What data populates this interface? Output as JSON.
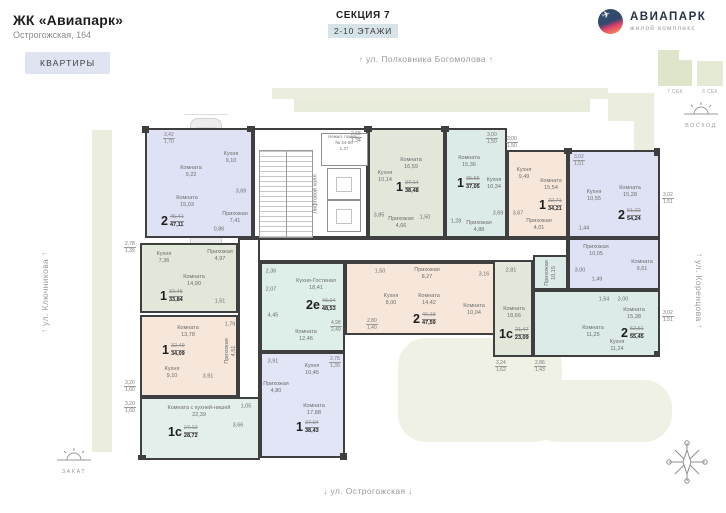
{
  "header": {
    "title": "ЖК «Авиапарк»",
    "address": "Острогожская, 164",
    "apartments_button": "КВАРТИРЫ",
    "section": "СЕКЦИЯ 7",
    "floors": "2-10 ЭТАЖИ",
    "logo": {
      "name": "АВИАПАРК",
      "subtitle": "жилой комплекс"
    }
  },
  "icons": {
    "arrow_up": "↑",
    "arrow_down": "↓",
    "plane": "✈"
  },
  "minimap": {
    "sec7": "7 СЕК",
    "sec6": "6 СЕК"
  },
  "streets": {
    "top": "ул. Полковника Богомолова",
    "left": "ул. Ключникова",
    "right": "ул. Коренцова",
    "bottom": "ул. Острогожская"
  },
  "markers": {
    "sunrise": "ВОСХОД",
    "sunset": "ЗАКАТ"
  },
  "core": {
    "nonres_l1": "Нежил. помещ.",
    "nonres_l2": "№ 44-50",
    "nonres_area": "1,47",
    "hall": "Лифтовой холл"
  },
  "apartments": [
    {
      "id": "1",
      "type": "2",
      "area_base": "45,41",
      "area_total": "47,11",
      "rooms": [
        {
          "name": "Комната",
          "area": "9,22"
        },
        {
          "name": "Кухня",
          "area": "9,10"
        },
        {
          "name": "Комната",
          "area": "15,03"
        },
        {
          "name": "Прихожая",
          "area": "7,41"
        },
        {
          "name": "",
          "area": "3,69"
        },
        {
          "name": "",
          "area": "0,86"
        }
      ],
      "balconies": [
        {
          "full": "3,42",
          "half": "1,70"
        }
      ]
    },
    {
      "id": "2",
      "type": "1",
      "area_base": "32,45",
      "area_total": "33,84",
      "rooms": [
        {
          "name": "Кухня",
          "area": "7,36"
        },
        {
          "name": "Прихожая",
          "area": "4,97"
        },
        {
          "name": "Комната",
          "area": "14,90"
        },
        {
          "name": "",
          "area": "1,51"
        }
      ],
      "balconies": [
        {
          "full": "2,78",
          "half": "1,39"
        }
      ]
    },
    {
      "id": "3",
      "type": "1",
      "area_base": "32,49",
      "area_total": "34,09",
      "rooms": [
        {
          "name": "Комната",
          "area": "13,78"
        },
        {
          "name": "",
          "area": "1,79"
        },
        {
          "name": "Прихожая",
          "area": "4,51"
        },
        {
          "name": "Кухня",
          "area": "9,10"
        },
        {
          "name": "",
          "area": "3,91"
        }
      ],
      "balconies": [
        {
          "full": "3,20",
          "half": "1,60"
        }
      ]
    },
    {
      "id": "4",
      "type": "1с",
      "area_base": "27,12",
      "area_total": "28,72",
      "rooms": [
        {
          "name": "Комната с кухней-нишей",
          "area": "22,39"
        },
        {
          "name": "",
          "area": "1,05"
        },
        {
          "name": "",
          "area": "3,66"
        }
      ],
      "balconies": [
        {
          "full": "3,20",
          "half": "1,60"
        }
      ]
    },
    {
      "id": "5",
      "type": "1",
      "area_base": "37,04",
      "area_total": "38,43",
      "rooms": [
        {
          "name": "Кухня",
          "area": "10,45"
        },
        {
          "name": "Прихожая",
          "area": "4,80"
        },
        {
          "name": "Комната",
          "area": "17,88"
        },
        {
          "name": "",
          "area": "3,91"
        }
      ],
      "balconies": [
        {
          "full": "2,78",
          "half": "1,39"
        }
      ]
    },
    {
      "id": "6",
      "type": "2е",
      "area_base": "46,04",
      "area_total": "48,53",
      "rooms": [
        {
          "name": "Кухня-Гостиная",
          "area": "18,41"
        },
        {
          "name": "Комната",
          "area": "12,46"
        },
        {
          "name": "",
          "area": "2,36"
        },
        {
          "name": "",
          "area": "2,07"
        },
        {
          "name": "",
          "area": "4,45"
        }
      ],
      "balconies": [
        {
          "full": "4,98",
          "half": "2,49"
        }
      ]
    },
    {
      "id": "7",
      "type": "2",
      "area_base": "46,19",
      "area_total": "47,59",
      "rooms": [
        {
          "name": "Прихожая",
          "area": "8,27"
        },
        {
          "name": "Кухня",
          "area": "8,00"
        },
        {
          "name": "Комната",
          "area": "14,42"
        },
        {
          "name": "Комната",
          "area": "10,04"
        },
        {
          "name": "",
          "area": "3,16"
        },
        {
          "name": "",
          "area": "1,50"
        }
      ],
      "balconies": [
        {
          "full": "2,80",
          "half": "1,40"
        }
      ]
    },
    {
      "id": "8",
      "type": "1",
      "area_base": "37,14",
      "area_total": "38,48",
      "rooms": [
        {
          "name": "Кухня",
          "area": "10,14"
        },
        {
          "name": "Комната",
          "area": "16,59"
        },
        {
          "name": "Прихожая",
          "area": "4,66"
        },
        {
          "name": "",
          "area": "3,85"
        },
        {
          "name": "",
          "area": "1,50"
        }
      ],
      "balconies": [
        {
          "full": "2,68",
          "half": "1,34"
        }
      ]
    },
    {
      "id": "9",
      "type": "1",
      "area_base": "35,55",
      "area_total": "37,05",
      "rooms": [
        {
          "name": "Комната",
          "area": "15,36"
        },
        {
          "name": "Кухня",
          "area": "10,34"
        },
        {
          "name": "Прихожая",
          "area": "4,88"
        },
        {
          "name": "",
          "area": "3,69"
        },
        {
          "name": "",
          "area": "1,28"
        }
      ],
      "balconies": [
        {
          "full": "3,00",
          "half": "1,50"
        }
      ]
    },
    {
      "id": "10",
      "type": "1",
      "area_base": "32,71",
      "area_total": "34,21",
      "rooms": [
        {
          "name": "Кухня",
          "area": "9,49"
        },
        {
          "name": "Комната",
          "area": "15,54"
        },
        {
          "name": "Прихожая",
          "area": "4,01"
        },
        {
          "name": "",
          "area": "3,67"
        }
      ],
      "balconies": [
        {
          "full": "3,00",
          "half": "1,50"
        }
      ]
    },
    {
      "id": "11",
      "type": "2",
      "area_base": "51,22",
      "area_total": "54,24",
      "rooms": [
        {
          "name": "Кухня",
          "area": "10,55"
        },
        {
          "name": "Комната",
          "area": "15,28"
        },
        {
          "name": "Прихожая",
          "area": "10,05"
        },
        {
          "name": "Комната",
          "area": "9,61"
        },
        {
          "name": "",
          "area": "1,44"
        },
        {
          "name": "",
          "area": "3,00"
        },
        {
          "name": "",
          "area": "1,49"
        }
      ],
      "balconies": [
        {
          "full": "3,02",
          "half": "1,51"
        },
        {
          "full": "3,02",
          "half": "1,51"
        }
      ]
    },
    {
      "id": "12",
      "type": "2",
      "area_base": "52,51",
      "area_total": "55,45",
      "rooms": [
        {
          "name": "Комната",
          "area": "15,38"
        },
        {
          "name": "Комната",
          "area": "11,25"
        },
        {
          "name": "Кухня",
          "area": "11,24"
        },
        {
          "name": "Прихожая",
          "area": "10,15"
        },
        {
          "name": "",
          "area": "1,54"
        },
        {
          "name": "",
          "area": "3,00"
        }
      ],
      "balconies": [
        {
          "full": "2,86",
          "half": "1,43"
        },
        {
          "full": "3,02",
          "half": "1,51"
        }
      ]
    },
    {
      "id": "13",
      "type": "1с",
      "area_base": "21,47",
      "area_total": "23,09",
      "rooms": [
        {
          "name": "Комната",
          "area": "18,66"
        },
        {
          "name": "",
          "area": "2,81"
        }
      ],
      "balconies": [
        {
          "full": "3,24",
          "half": "1,62"
        }
      ]
    }
  ]
}
